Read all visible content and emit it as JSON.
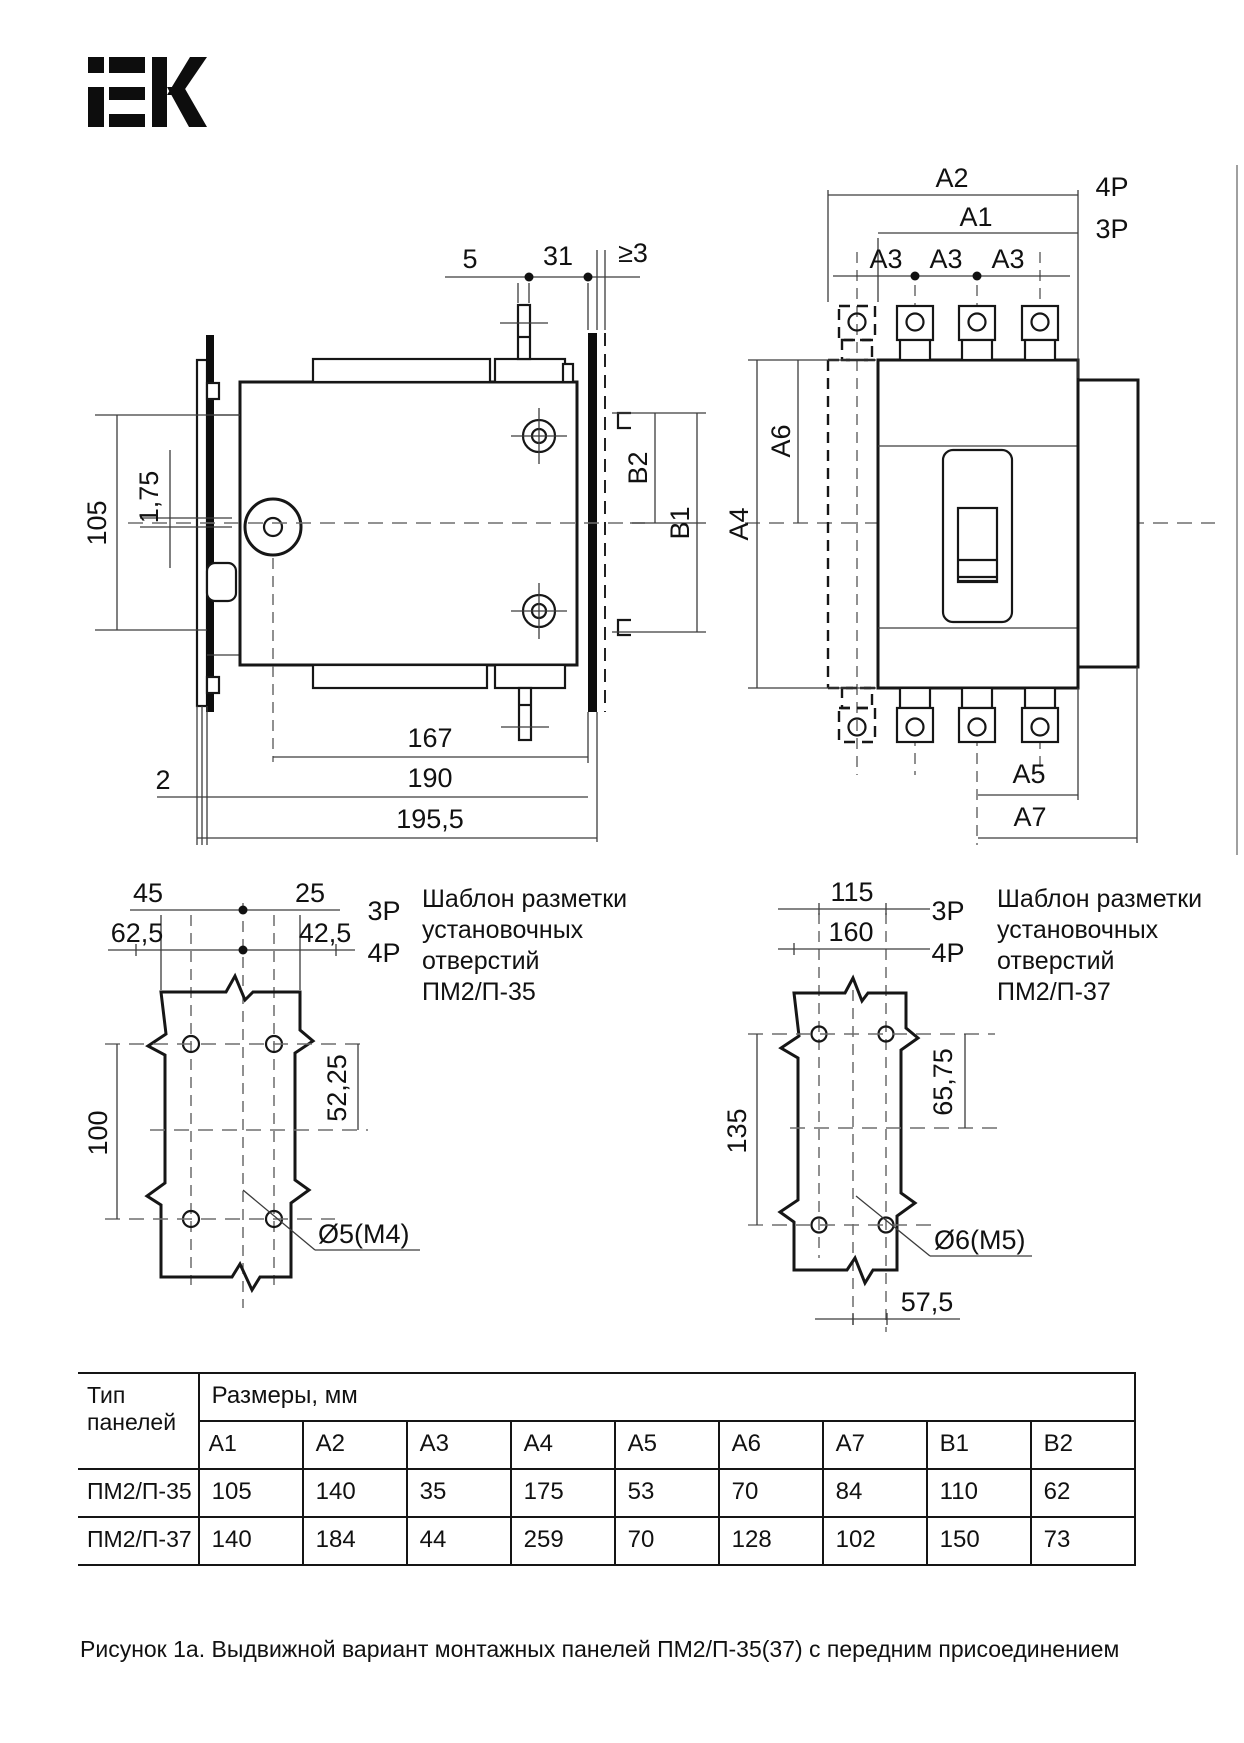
{
  "brand": {
    "name": "IEK"
  },
  "side_view": {
    "d5": "5",
    "d31": "31",
    "dge3": "≥3",
    "d105": "105",
    "d175": "1,75",
    "d167": "167",
    "d190": "190",
    "d1955": "195,5",
    "d2": "2",
    "b1": "B1",
    "b2": "B2"
  },
  "front_view": {
    "a1": "A1",
    "a2": "A2",
    "a3": "A3",
    "a4": "A4",
    "a5": "A5",
    "a6": "A6",
    "a7": "A7",
    "p4": "4P",
    "p3": "3P"
  },
  "template_35": {
    "d45": "45",
    "d25": "25",
    "d625": "62,5",
    "d425": "42,5",
    "p3": "3P",
    "p4": "4P",
    "d100": "100",
    "d5225": "52,25",
    "hole": "Ø5(M4)",
    "t1": "Шаблон разметки",
    "t2": "установочных",
    "t3": "отверстий",
    "t4": "ПМ2/П-35"
  },
  "template_37": {
    "d115": "115",
    "d160": "160",
    "p3": "3P",
    "p4": "4P",
    "d135": "135",
    "d6575": "65,75",
    "hole": "Ø6(M5)",
    "d575": "57,5",
    "t1": "Шаблон разметки",
    "t2": "установочных",
    "t3": "отверстий",
    "t4": "ПМ2/П-37"
  },
  "table": {
    "type_header": "Тип панелей",
    "sizes_header": "Размеры, мм",
    "columns": [
      "A1",
      "A2",
      "A3",
      "A4",
      "A5",
      "A6",
      "A7",
      "B1",
      "B2"
    ],
    "rows": [
      {
        "type": "ПМ2/П-35",
        "values": [
          "105",
          "140",
          "35",
          "175",
          "53",
          "70",
          "84",
          "110",
          "62"
        ]
      },
      {
        "type": "ПМ2/П-37",
        "values": [
          "140",
          "184",
          "44",
          "259",
          "70",
          "128",
          "102",
          "150",
          "73"
        ]
      }
    ]
  },
  "caption": "Рисунок 1а.  Выдвижной вариант монтажных панелей ПМ2/П-35(37) с передним присоединением"
}
